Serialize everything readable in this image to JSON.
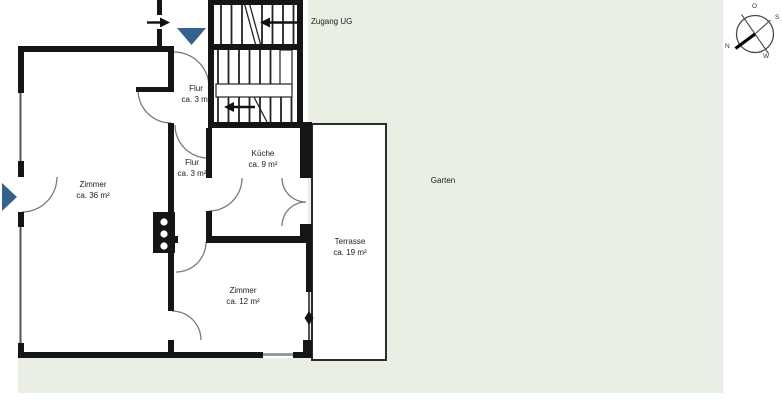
{
  "plan": {
    "rooms": [
      {
        "id": "zimmer-36",
        "name": "Zimmer",
        "area": "ca. 36 m²"
      },
      {
        "id": "flur-upper",
        "name": "Flur",
        "area": "ca. 3 m²"
      },
      {
        "id": "flur-lower",
        "name": "Flur",
        "area": "ca. 3 m²"
      },
      {
        "id": "kueche",
        "name": "Küche",
        "area": "ca. 9 m²"
      },
      {
        "id": "zimmer-12",
        "name": "Zimmer",
        "area": "ca. 12 m²"
      },
      {
        "id": "terrasse",
        "name": "Terrasse",
        "area": "ca. 19 m²"
      },
      {
        "id": "garten",
        "name": "Garten",
        "area": ""
      }
    ],
    "annotations": {
      "zugang_ug": "Zugang UG"
    },
    "compass": {
      "o": "O",
      "s": "S",
      "n": "N",
      "w": "W"
    },
    "colors": {
      "garden": "#e9efe2",
      "wall": "#151515",
      "entrance_marker": "#35618d",
      "entrance_marker_border": "#22415f"
    }
  }
}
